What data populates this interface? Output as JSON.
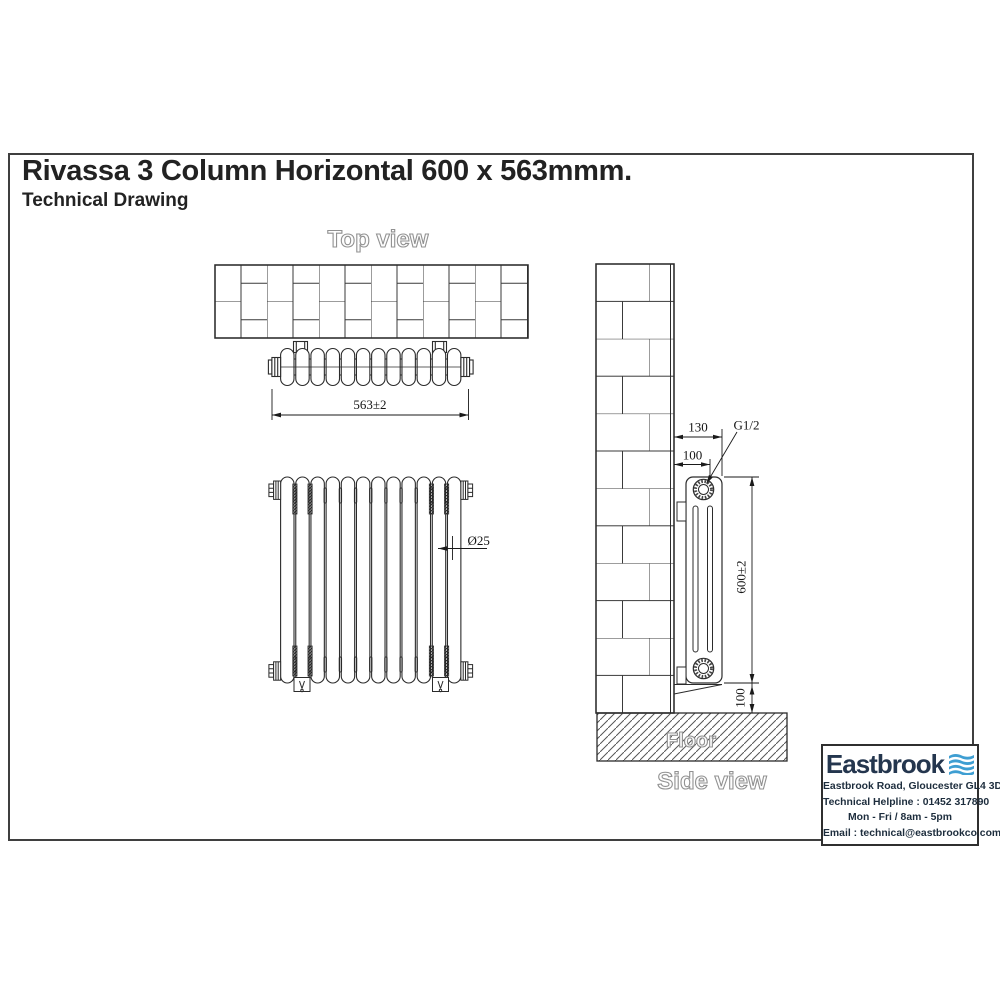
{
  "page": {
    "title": "Rivassa 3 Column Horizontal 600 x 563mmm.",
    "subtitle": "Technical Drawing"
  },
  "views": {
    "top": {
      "label": "Top view",
      "width_dim": "563±2"
    },
    "front": {
      "column_dim": "Ø25"
    },
    "side": {
      "label": "Side view",
      "floor_label": "Floor",
      "depth_dim": "130",
      "pipe_dim": "100",
      "thread_dim": "G1/2",
      "height_dim": "600±2",
      "floor_clearance_dim": "100"
    }
  },
  "brand": {
    "name": "Eastbrook",
    "address": "Eastbrook Road, Gloucester GL4 3DB",
    "helpline": "Technical Helpline : 01452 317890",
    "hours": "Mon - Fri / 8am - 5pm",
    "email": "Email : technical@eastbrookco.com",
    "colors": {
      "navy": "#24364e",
      "blue": "#3e9ed2"
    }
  }
}
